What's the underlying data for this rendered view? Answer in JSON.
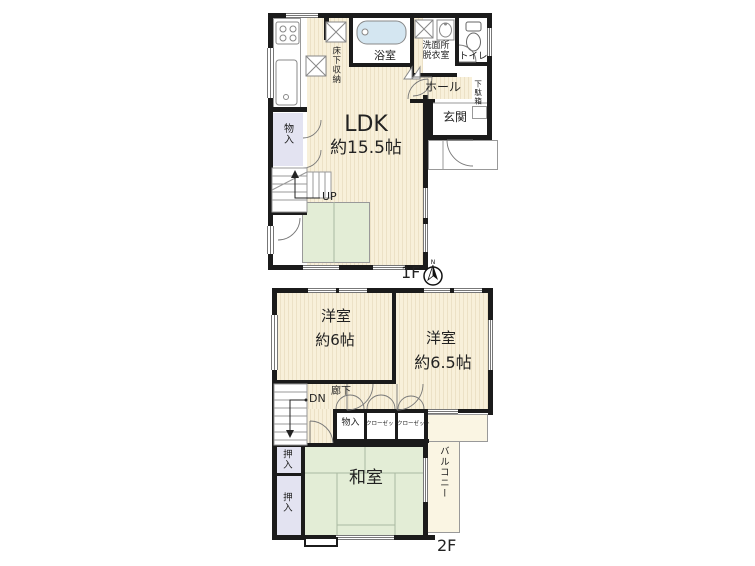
{
  "colors": {
    "wall": "#1b1b1b",
    "floor_cream": "#f8f0da",
    "stripe": "#ece1c6",
    "tatami": "#e3edd6",
    "tatami_line": "#a9b9a1",
    "closet_lavender": "#e3e3f1",
    "bath_blue": "#d4e6f1",
    "balcony_cream": "#faf5e3",
    "outline_gray": "#999999",
    "text": "#222222"
  },
  "f1": {
    "marker": "1F",
    "ldk": "LDK",
    "ldk_size": "約15.5帖",
    "kitchen_storage": "床下収納",
    "bath": "浴室",
    "washroom_line1": "洗面所",
    "washroom_line2": "脱衣室",
    "toilet": "トイレ",
    "hall": "ホール",
    "shoe_box": "下駄箱",
    "entrance": "玄関",
    "storage": "物入",
    "up": "UP"
  },
  "f2": {
    "marker": "2F",
    "room1": "洋室",
    "room1_size": "約6帖",
    "room2": "洋室",
    "room2_size": "約6.5帖",
    "dn": "DN",
    "corridor": "廊下",
    "storage": "物入",
    "closet1": "クローゼット",
    "closet2": "クローゼット",
    "oshiire1": "押入",
    "oshiire2": "押入",
    "tatami_room": "和室",
    "balcony": "バルコニー"
  },
  "compass": {
    "n": "N"
  }
}
